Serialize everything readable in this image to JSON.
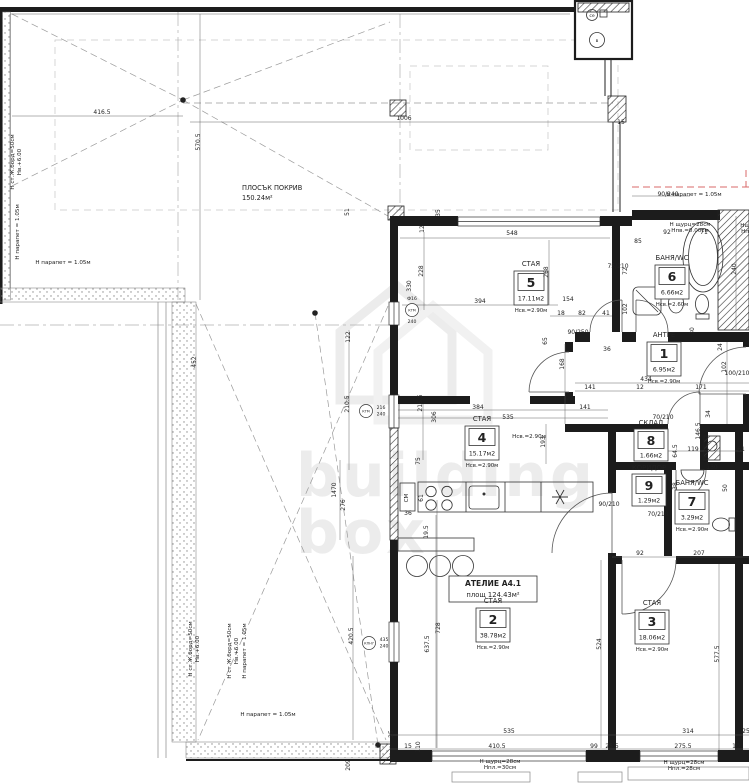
{
  "roof": {
    "name": "ПЛОСЪК ПОКРИВ",
    "area": "150.24м²"
  },
  "unit": {
    "title": "АТЕЛИЕ А4.1",
    "area": "площ 124.43м²"
  },
  "watermark": {
    "line1": "building",
    "line2": "box"
  },
  "shaft": {
    "cap1": "се",
    "cap2": "в"
  },
  "colors": {
    "wall": "#1c1c1c",
    "red_parapet": "#d96a6a",
    "watermark": "#ececec",
    "stipple": "#8a8a8a"
  },
  "rooms": [
    {
      "type": "СТАЯ",
      "number": "5",
      "area": "17.11м2",
      "height": "Нсв.=2.90м"
    },
    {
      "type": "БАНЯ/WC",
      "number": "6",
      "area": "6.66м2",
      "height": "Нсв.=2.60м"
    },
    {
      "type": "АНТРЕ",
      "number": "1",
      "area": "6.95м2",
      "height": "Нсв.=2.90м"
    },
    {
      "type": "СКЛАД",
      "number": "8",
      "area": "1.66м2",
      "height": ""
    },
    {
      "type": "КОРИДОР",
      "number": "9",
      "area": "1.29м2",
      "height": ""
    },
    {
      "type": "БАНЯ/WC",
      "number": "7",
      "area": "3.29м2",
      "height": "Нсв.=2.90м"
    },
    {
      "type": "СТАЯ",
      "number": "4",
      "area": "15.17м2",
      "height": "Нсв.=2.90м"
    },
    {
      "type": "СТАЯ",
      "number": "2",
      "area": "38.78м2",
      "height": "Нсв.=2.90м"
    },
    {
      "type": "СТАЯ",
      "number": "3",
      "area": "18.06м2",
      "height": "Нсв.=2.90м"
    }
  ],
  "window_markers": [
    {
      "code": "КТМ",
      "w": "216",
      "h": "240"
    },
    {
      "code": "КПН7",
      "w": "435",
      "h": "240"
    },
    {
      "code": "КТМ",
      "w": "Ф16",
      "h": "240"
    }
  ],
  "annotations": [
    {
      "t": "Н парапет = 1.05м",
      "x": 63,
      "y": 264
    },
    {
      "t": "Н парапет = 1.05м",
      "x": 19,
      "y": 232,
      "r": -90
    },
    {
      "t": "Н ст.Ж.борд=50см",
      "x": 14,
      "y": 162,
      "r": -90
    },
    {
      "t": "Нв.+6.00",
      "x": 21,
      "y": 162,
      "r": -90
    },
    {
      "t": "Н ст.Ж.борд=50см",
      "x": 192,
      "y": 649,
      "r": -90
    },
    {
      "t": "Нв.+6.00",
      "x": 199,
      "y": 649,
      "r": -90
    },
    {
      "t": "Н ст.Ж.борд=50см",
      "x": 231,
      "y": 651,
      "r": -90
    },
    {
      "t": "Нв.+6.00",
      "x": 238,
      "y": 651,
      "r": -90
    },
    {
      "t": "Н парапет = 1.05м",
      "x": 246,
      "y": 651,
      "r": -90
    },
    {
      "t": "Н парапет = 1.05м",
      "x": 268,
      "y": 716
    },
    {
      "t": "Н парапет = 1.05м",
      "x": 694,
      "y": 196
    },
    {
      "t": "Н щурц=28см",
      "x": 690,
      "y": 226
    },
    {
      "t": "Нпв.=0.00см",
      "x": 690,
      "y": 232
    },
    {
      "t": "Нсв.=2.90м",
      "x": 529,
      "y": 438
    },
    {
      "t": "Н щурц=28см",
      "x": 500,
      "y": 763
    },
    {
      "t": "Нпл.=30см",
      "x": 500,
      "y": 769
    },
    {
      "t": "Н щурц=28см",
      "x": 684,
      "y": 764
    },
    {
      "t": "Нпл.=28см",
      "x": 684,
      "y": 770
    },
    {
      "t": "Нщ",
      "x": 745,
      "y": 227
    },
    {
      "t": "Нп",
      "x": 745,
      "y": 233
    },
    {
      "t": "СМ",
      "x": 408,
      "y": 498,
      "r": -90
    }
  ],
  "dimensions": [
    {
      "t": "416.5",
      "x": 102,
      "y": 114
    },
    {
      "t": "570.5",
      "x": 200,
      "y": 142,
      "r": -90
    },
    {
      "t": "1006",
      "x": 404,
      "y": 120
    },
    {
      "t": "15",
      "x": 621,
      "y": 124
    },
    {
      "t": "51",
      "x": 349,
      "y": 212,
      "r": -90
    },
    {
      "t": "548",
      "x": 512,
      "y": 235
    },
    {
      "t": "12",
      "x": 424,
      "y": 229,
      "r": -90
    },
    {
      "t": "35",
      "x": 440,
      "y": 213,
      "r": -90
    },
    {
      "t": "228",
      "x": 423,
      "y": 271,
      "r": -90
    },
    {
      "t": "330",
      "x": 411,
      "y": 286,
      "r": -90
    },
    {
      "t": "394",
      "x": 480,
      "y": 303
    },
    {
      "t": "268",
      "x": 548,
      "y": 272,
      "r": -90
    },
    {
      "t": "154",
      "x": 568,
      "y": 301
    },
    {
      "t": "18",
      "x": 561,
      "y": 315
    },
    {
      "t": "82",
      "x": 582,
      "y": 315
    },
    {
      "t": "41",
      "x": 606,
      "y": 315
    },
    {
      "t": "65",
      "x": 547,
      "y": 341,
      "r": -90
    },
    {
      "t": "90/250",
      "x": 578,
      "y": 334
    },
    {
      "t": "92",
      "x": 667,
      "y": 234
    },
    {
      "t": "71",
      "x": 704,
      "y": 234
    },
    {
      "t": "240",
      "x": 736,
      "y": 269,
      "r": -90
    },
    {
      "t": "72",
      "x": 627,
      "y": 271,
      "r": -90
    },
    {
      "t": "102",
      "x": 627,
      "y": 309,
      "r": -90
    },
    {
      "t": "85",
      "x": 638,
      "y": 243
    },
    {
      "t": "75/210",
      "x": 618,
      "y": 268
    },
    {
      "t": "90/240",
      "x": 668,
      "y": 196
    },
    {
      "t": "30",
      "x": 694,
      "y": 331,
      "r": -90
    },
    {
      "t": "434",
      "x": 646,
      "y": 381
    },
    {
      "t": "141",
      "x": 590,
      "y": 389
    },
    {
      "t": "12",
      "x": 640,
      "y": 389
    },
    {
      "t": "171",
      "x": 701,
      "y": 389
    },
    {
      "t": "168",
      "x": 564,
      "y": 364,
      "r": -90
    },
    {
      "t": "36",
      "x": 607,
      "y": 351
    },
    {
      "t": "100/210",
      "x": 737,
      "y": 375
    },
    {
      "t": "102",
      "x": 726,
      "y": 367,
      "r": -90
    },
    {
      "t": "24",
      "x": 722,
      "y": 347,
      "r": -90
    },
    {
      "t": "119",
      "x": 693,
      "y": 451
    },
    {
      "t": "146.5",
      "x": 700,
      "y": 431,
      "r": -90
    },
    {
      "t": "64.5",
      "x": 677,
      "y": 451,
      "r": -90
    },
    {
      "t": "63.5",
      "x": 708,
      "y": 451,
      "r": -90
    },
    {
      "t": "70/210",
      "x": 663,
      "y": 419
    },
    {
      "t": "70/210",
      "x": 658,
      "y": 516
    },
    {
      "t": "130",
      "x": 712,
      "y": 469
    },
    {
      "t": "38",
      "x": 677,
      "y": 486,
      "r": -90
    },
    {
      "t": "50",
      "x": 727,
      "y": 488,
      "r": -90
    },
    {
      "t": "61",
      "x": 741,
      "y": 451
    },
    {
      "t": "34",
      "x": 710,
      "y": 414,
      "r": -90
    },
    {
      "t": "90/210",
      "x": 609,
      "y": 506
    },
    {
      "t": "384",
      "x": 478,
      "y": 409
    },
    {
      "t": "535",
      "x": 508,
      "y": 419
    },
    {
      "t": "141",
      "x": 585,
      "y": 409
    },
    {
      "t": "216.5",
      "x": 422,
      "y": 403,
      "r": -90
    },
    {
      "t": "306",
      "x": 436,
      "y": 417,
      "r": -90
    },
    {
      "t": "193",
      "x": 545,
      "y": 442,
      "r": -90
    },
    {
      "t": "75",
      "x": 420,
      "y": 461,
      "r": -90
    },
    {
      "t": "61",
      "x": 423,
      "y": 498,
      "r": -90
    },
    {
      "t": "36",
      "x": 408,
      "y": 515
    },
    {
      "t": "19.5",
      "x": 428,
      "y": 532,
      "r": -90
    },
    {
      "t": "728",
      "x": 440,
      "y": 628,
      "r": -90
    },
    {
      "t": "637.5",
      "x": 429,
      "y": 644,
      "r": -90
    },
    {
      "t": "420.5",
      "x": 353,
      "y": 636,
      "r": -90
    },
    {
      "t": "524",
      "x": 601,
      "y": 644,
      "r": -90
    },
    {
      "t": "577.5",
      "x": 719,
      "y": 654,
      "r": -90
    },
    {
      "t": "92",
      "x": 640,
      "y": 555
    },
    {
      "t": "207",
      "x": 699,
      "y": 555
    },
    {
      "t": "314",
      "x": 688,
      "y": 733
    },
    {
      "t": "275.5",
      "x": 683,
      "y": 748
    },
    {
      "t": "10",
      "x": 736,
      "y": 748
    },
    {
      "t": "25",
      "x": 746,
      "y": 733
    },
    {
      "t": "535",
      "x": 509,
      "y": 733
    },
    {
      "t": "410.5",
      "x": 497,
      "y": 748
    },
    {
      "t": "99",
      "x": 594,
      "y": 748
    },
    {
      "t": "110",
      "x": 420,
      "y": 747,
      "r": -90
    },
    {
      "t": "15",
      "x": 408,
      "y": 748
    },
    {
      "t": "25.5",
      "x": 612,
      "y": 748
    },
    {
      "t": "209",
      "x": 350,
      "y": 765,
      "r": -90
    },
    {
      "t": "25",
      "x": 393,
      "y": 734,
      "r": -90
    },
    {
      "t": "452",
      "x": 196,
      "y": 362,
      "r": -90
    },
    {
      "t": "210.5",
      "x": 349,
      "y": 404,
      "r": -90
    },
    {
      "t": "1470",
      "x": 336,
      "y": 490,
      "r": -90
    },
    {
      "t": "276",
      "x": 345,
      "y": 505,
      "r": -90
    },
    {
      "t": "122",
      "x": 350,
      "y": 337,
      "r": -90
    }
  ]
}
